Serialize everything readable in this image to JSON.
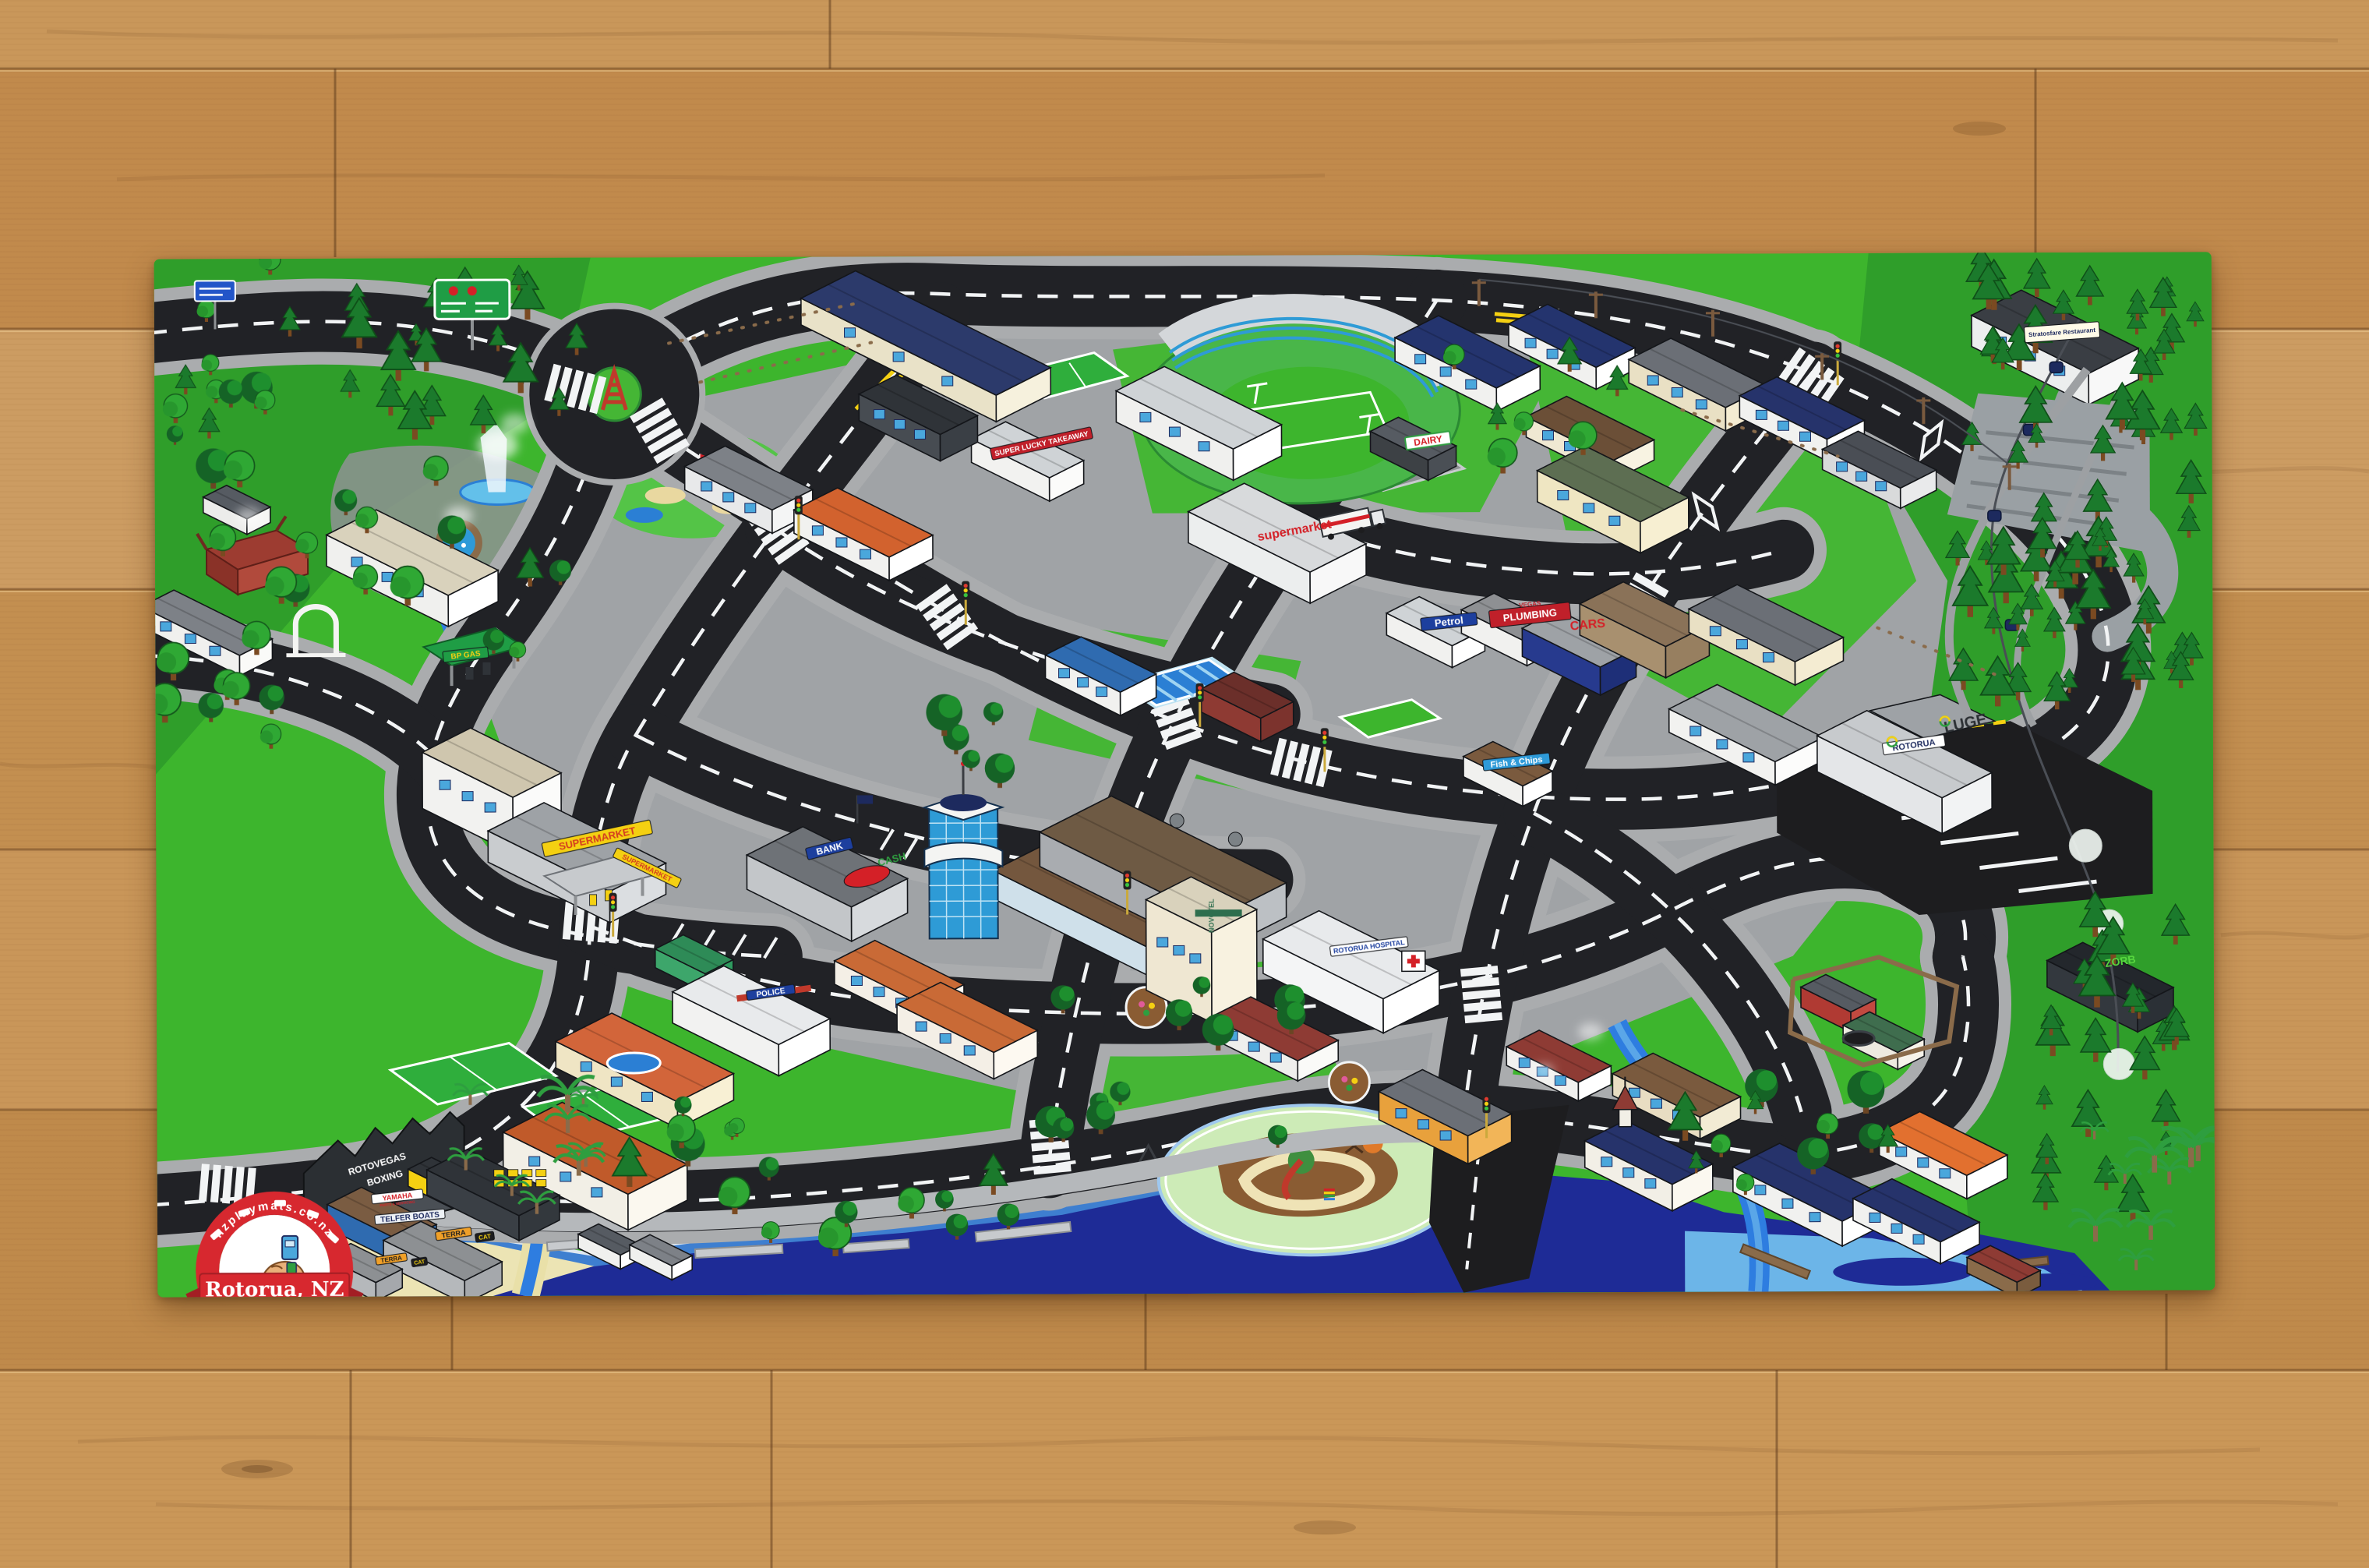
{
  "mat": {
    "brand": {
      "url": "nzplaymats.co.nz",
      "location": "Rotorua, NZ"
    },
    "labels": {
      "rotovegas_1": "ROTOVEGAS",
      "rotovegas_2": "BOXING",
      "yamaha": "YAMAHA",
      "yamaha_sub": "PARTS & SERVICING",
      "telfer": "TELFER BOATS",
      "terra": "TERRA",
      "cat": "CAT",
      "dairy": "DAIRY",
      "supermarket_white": "supermarket",
      "supermarket_yellow": "SUPERMARKET",
      "petrol": "Petrol",
      "plumbing_1": "VEGAS",
      "plumbing_2": "PLUMBING",
      "cars": "CARS",
      "fish_chips": "Fish & Chips",
      "super_lucky": "SUPER LUCKY TAKEAWAY",
      "bank": "BANK",
      "cash": "CASH",
      "novotel": "NOVOTEL",
      "hospital": "ROTORUA HOSPITAL",
      "skyline_rotorua": "ROTORUA",
      "skyline_luge": "LUGE",
      "stratosfare": "Stratosfare Restaurant",
      "zorb": "ZORB",
      "bp_gas": "BP GAS",
      "police": "POLICE"
    }
  },
  "palette": {
    "wood": "#c8935a",
    "mat_green": "#3db52d",
    "forest_green": "#2f9e2a",
    "road_black": "#212226",
    "sidewalk_grey": "#aaacae",
    "lake_navy": "#1e2b96",
    "lake_shallow": "#6cb5e8",
    "river_blue": "#2e7de0",
    "sand": "#ece4b4",
    "logo_red": "#d7282f"
  }
}
